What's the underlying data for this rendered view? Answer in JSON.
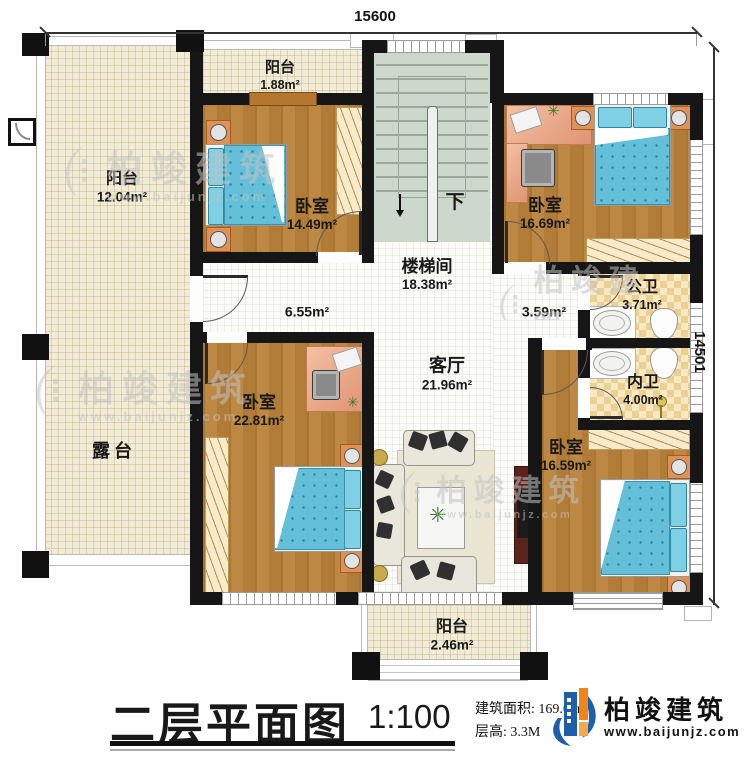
{
  "dimensions": {
    "top": "15600",
    "right": "14501"
  },
  "rooms": {
    "balcony_left": {
      "name": "阳台",
      "area": "12.04m²"
    },
    "balcony_top": {
      "name": "阳台",
      "area": "1.88m²"
    },
    "bedroom_tl": {
      "name": "卧室",
      "area": "14.49m²"
    },
    "bedroom_tr": {
      "name": "卧室",
      "area": "16.69m²"
    },
    "stairwell": {
      "name": "楼梯间",
      "area": "18.38m²"
    },
    "hall_left": {
      "area": "6.55m²"
    },
    "hall_right": {
      "area": "3.59m²"
    },
    "living": {
      "name": "客厅",
      "area": "21.96m²"
    },
    "bath_public": {
      "name": "公卫",
      "area": "3.71m²"
    },
    "bath_inner": {
      "name": "内卫",
      "area": "4.00m²"
    },
    "bedroom_bl": {
      "name": "卧室",
      "area": "22.81m²"
    },
    "bedroom_br": {
      "name": "卧室",
      "area": "16.59m²"
    },
    "terrace": {
      "name": "露台"
    },
    "balcony_bottom": {
      "name": "阳台",
      "area": "2.46m²"
    }
  },
  "stair": {
    "down_label": "下"
  },
  "titleblock": {
    "title": "二层平面图",
    "scale": "1:100",
    "area_label": "建筑面积:",
    "area_value": "169.60m²",
    "floor_height_label": "层高:",
    "floor_height_value": "3.3M"
  },
  "brand": {
    "name": "柏竣建筑",
    "website": "www.baijunjz.com"
  },
  "watermark": {
    "name": "柏竣建筑",
    "website": "www.baijunjz.com"
  },
  "colors": {
    "wall": "#161616",
    "wood": "#b5813f",
    "bed_blue": "#64bfd8",
    "brand_blue": "#1d5fa8",
    "brand_orange": "#f08519"
  }
}
